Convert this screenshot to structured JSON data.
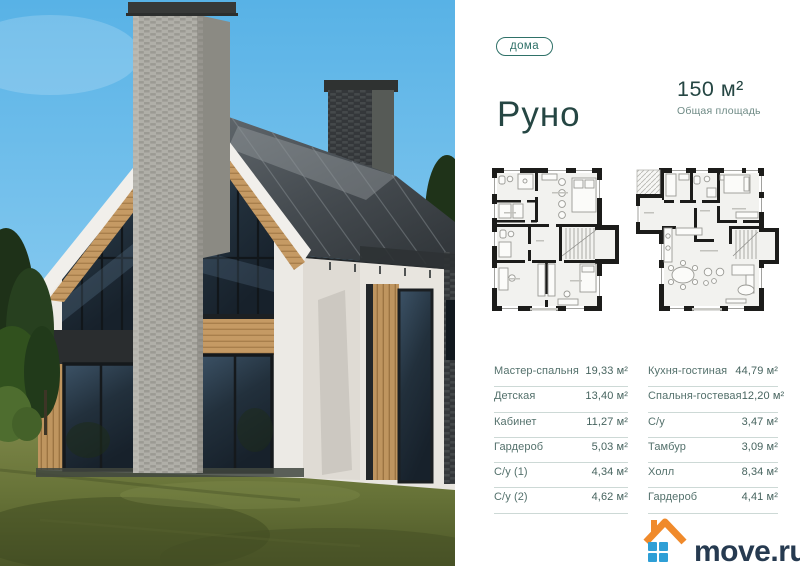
{
  "header": {
    "badge": "дома",
    "title": "Руно",
    "area_value": "150 м²",
    "area_label": "Общая площадь"
  },
  "rooms": {
    "left_column": [
      {
        "label": "Мастер-спальня",
        "area": "19,33 м²"
      },
      {
        "label": "Детская",
        "area": "13,40 м²"
      },
      {
        "label": "Кабинет",
        "area": "11,27 м²"
      },
      {
        "label": "Гардероб",
        "area": "5,03 м²"
      },
      {
        "label": "С/у (1)",
        "area": "4,34 м²"
      },
      {
        "label": "С/у (2)",
        "area": "4,62 м²"
      }
    ],
    "right_column": [
      {
        "label": "Кухня-гостиная",
        "area": "44,79 м²"
      },
      {
        "label": "Спальня-гостевая",
        "area": "12,20 м²"
      },
      {
        "label": "С/у",
        "area": "3,47 м²"
      },
      {
        "label": "Тамбур",
        "area": "3,09 м²"
      },
      {
        "label": "Холл",
        "area": "8,34 м²"
      },
      {
        "label": "Гардероб",
        "area": "4,41 м²"
      }
    ]
  },
  "footer": {
    "logo_text": "move.ru"
  },
  "colors": {
    "accent_teal": "#254643",
    "badge_teal": "#2f7168",
    "list_text": "#54716c",
    "divider": "#cdd9d6",
    "logo_navy": "#263a50",
    "logo_orange": "#f08a2b",
    "logo_blue": "#2f9fd6"
  },
  "icons": {
    "logo_mark": "house-roof-with-window-icon"
  }
}
